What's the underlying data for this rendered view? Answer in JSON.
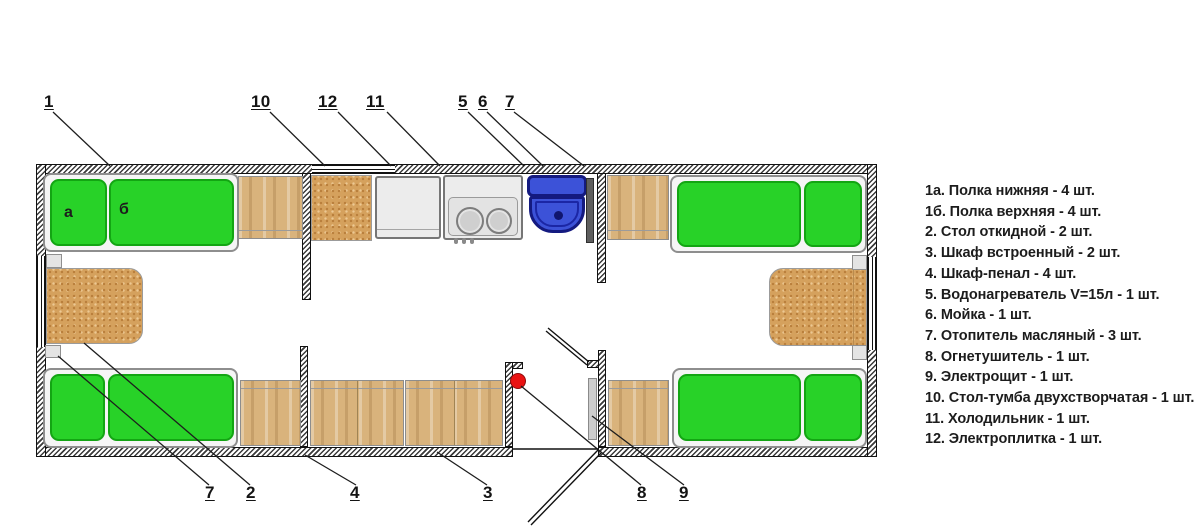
{
  "plan": {
    "shelf_letters": {
      "a": "а",
      "b": "б"
    },
    "callouts": {
      "t1": "1",
      "t10": "10",
      "t12": "12",
      "t11": "11",
      "t5": "5",
      "t6": "6",
      "t7": "7",
      "b7": "7",
      "b2": "2",
      "b4": "4",
      "b3": "3",
      "b8": "8",
      "b9": "9"
    }
  },
  "legend": {
    "items": [
      "1а. Полка нижняя - 4 шт.",
      "1б. Полка верхняя - 4 шт.",
      "2. Стол откидной - 2 шт.",
      "3. Шкаф встроенный - 2 шт.",
      "4. Шкаф-пенал - 4 шт.",
      "5. Водонагреватель V=15л - 1 шт.",
      "6. Мойка - 1 шт.",
      "7. Отопитель масляный - 3 шт.",
      "8. Огнетушитель - 1 шт.",
      "9. Электрощит - 1 шт.",
      "10. Стол-тумба двухстворчатая - 1 шт.",
      "11. Холодильник - 1 шт.",
      "12. Электроплитка - 1 шт."
    ]
  },
  "colors": {
    "shelf_green": "#28d228",
    "sink_blue": "#3c52d8",
    "extinguisher_red": "#ea1212",
    "wood": "#d9b37c",
    "chipboard": "#d5a15d"
  }
}
